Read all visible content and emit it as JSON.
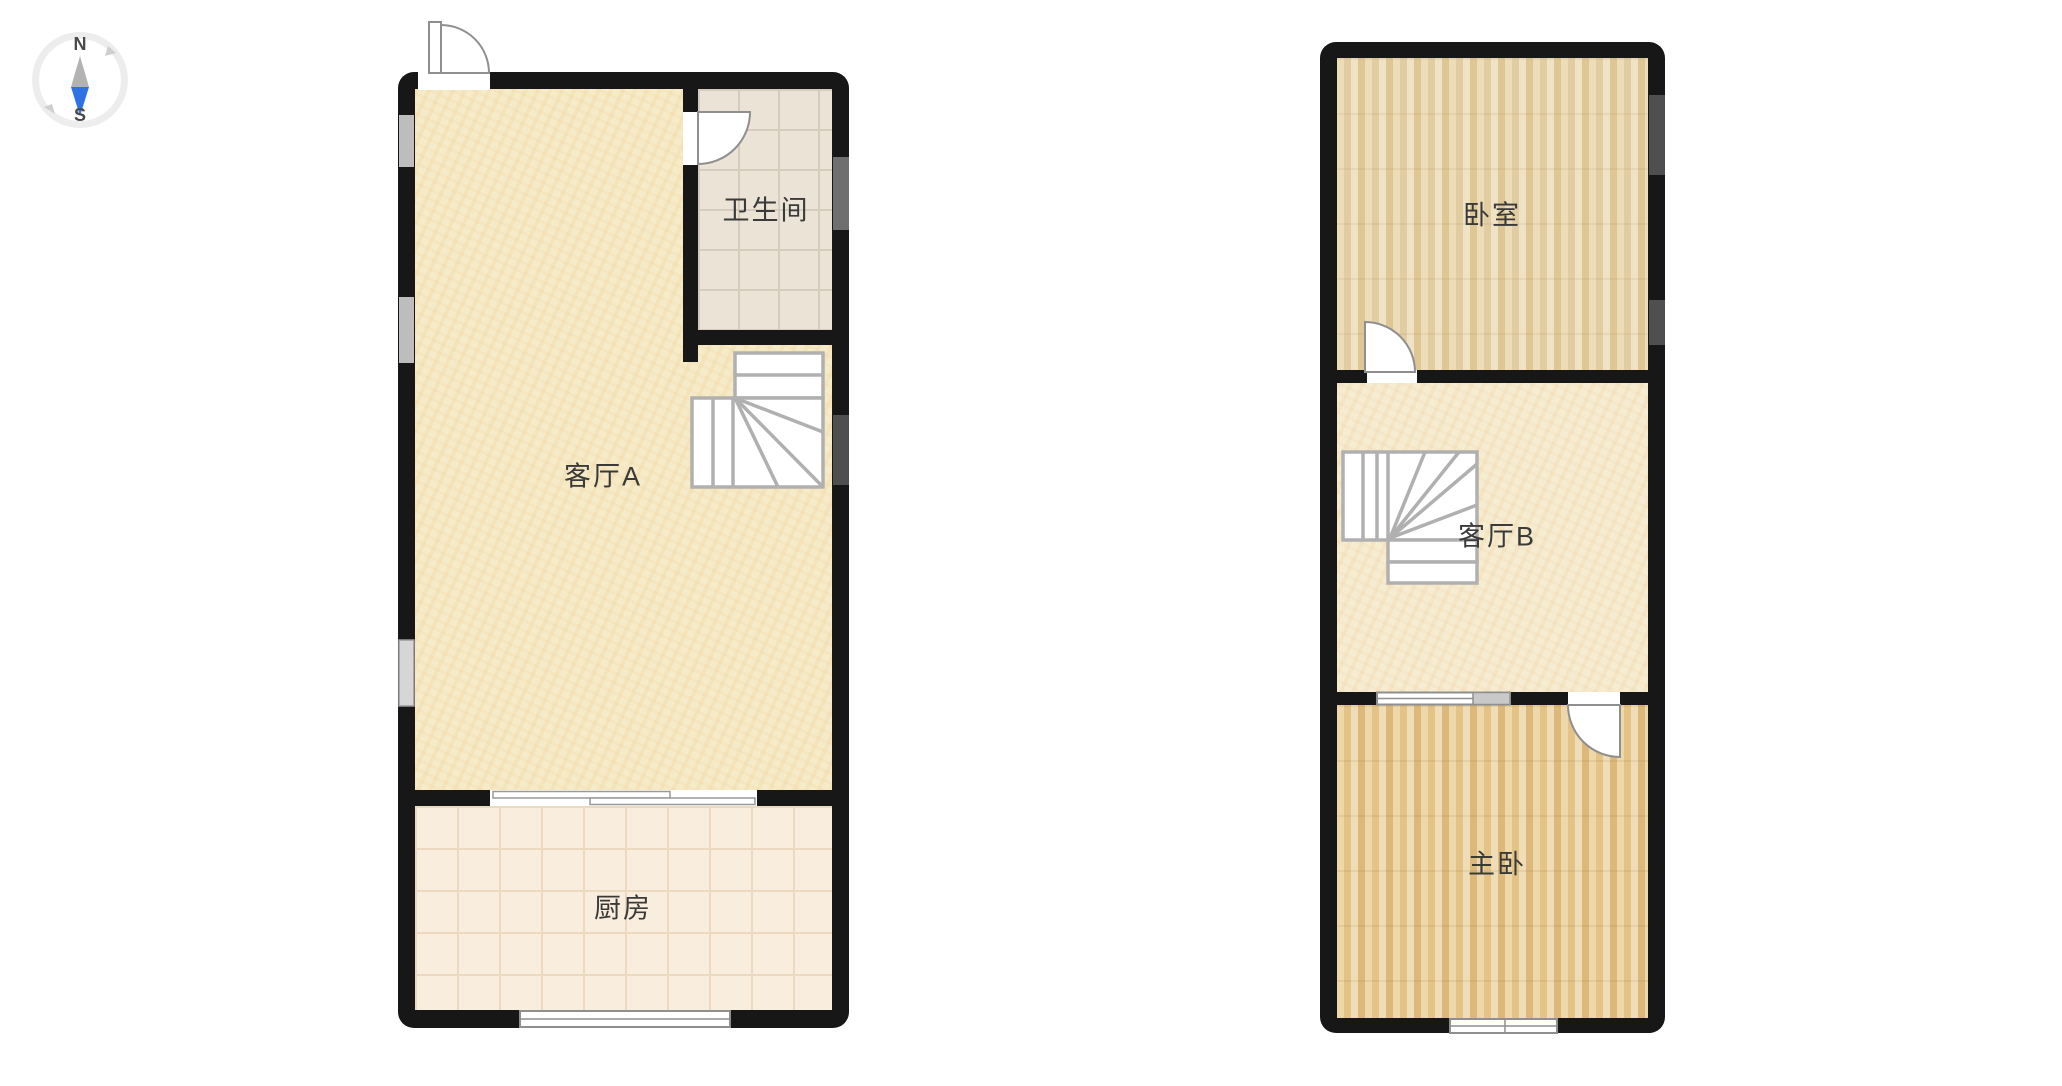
{
  "canvas": {
    "width": 2062,
    "height": 1086,
    "background": "#ffffff"
  },
  "compass": {
    "north": "N",
    "south": "S"
  },
  "floor1": {
    "rooms": {
      "living": {
        "label": "客厅A"
      },
      "bathroom": {
        "label": "卫生间"
      },
      "kitchen": {
        "label": "厨房"
      }
    }
  },
  "floor2": {
    "rooms": {
      "bedroom": {
        "label": "卧室"
      },
      "living": {
        "label": "客厅B"
      },
      "master": {
        "label": "主卧"
      }
    }
  },
  "colors": {
    "wall": "#171717",
    "living_floor": "#f6ebc8",
    "kitchen_floor": "#f9eedd",
    "bathroom_floor": "#eae3d6",
    "bedroom_wood": "#e5d0a6",
    "master_wood": "#e4c289",
    "stair_stroke": "#b0b0b0",
    "door_stroke": "#8f8f8f",
    "label": "#3a3a3a",
    "compass_blue": "#2f72e4",
    "compass_gray": "#b3b3b3"
  }
}
